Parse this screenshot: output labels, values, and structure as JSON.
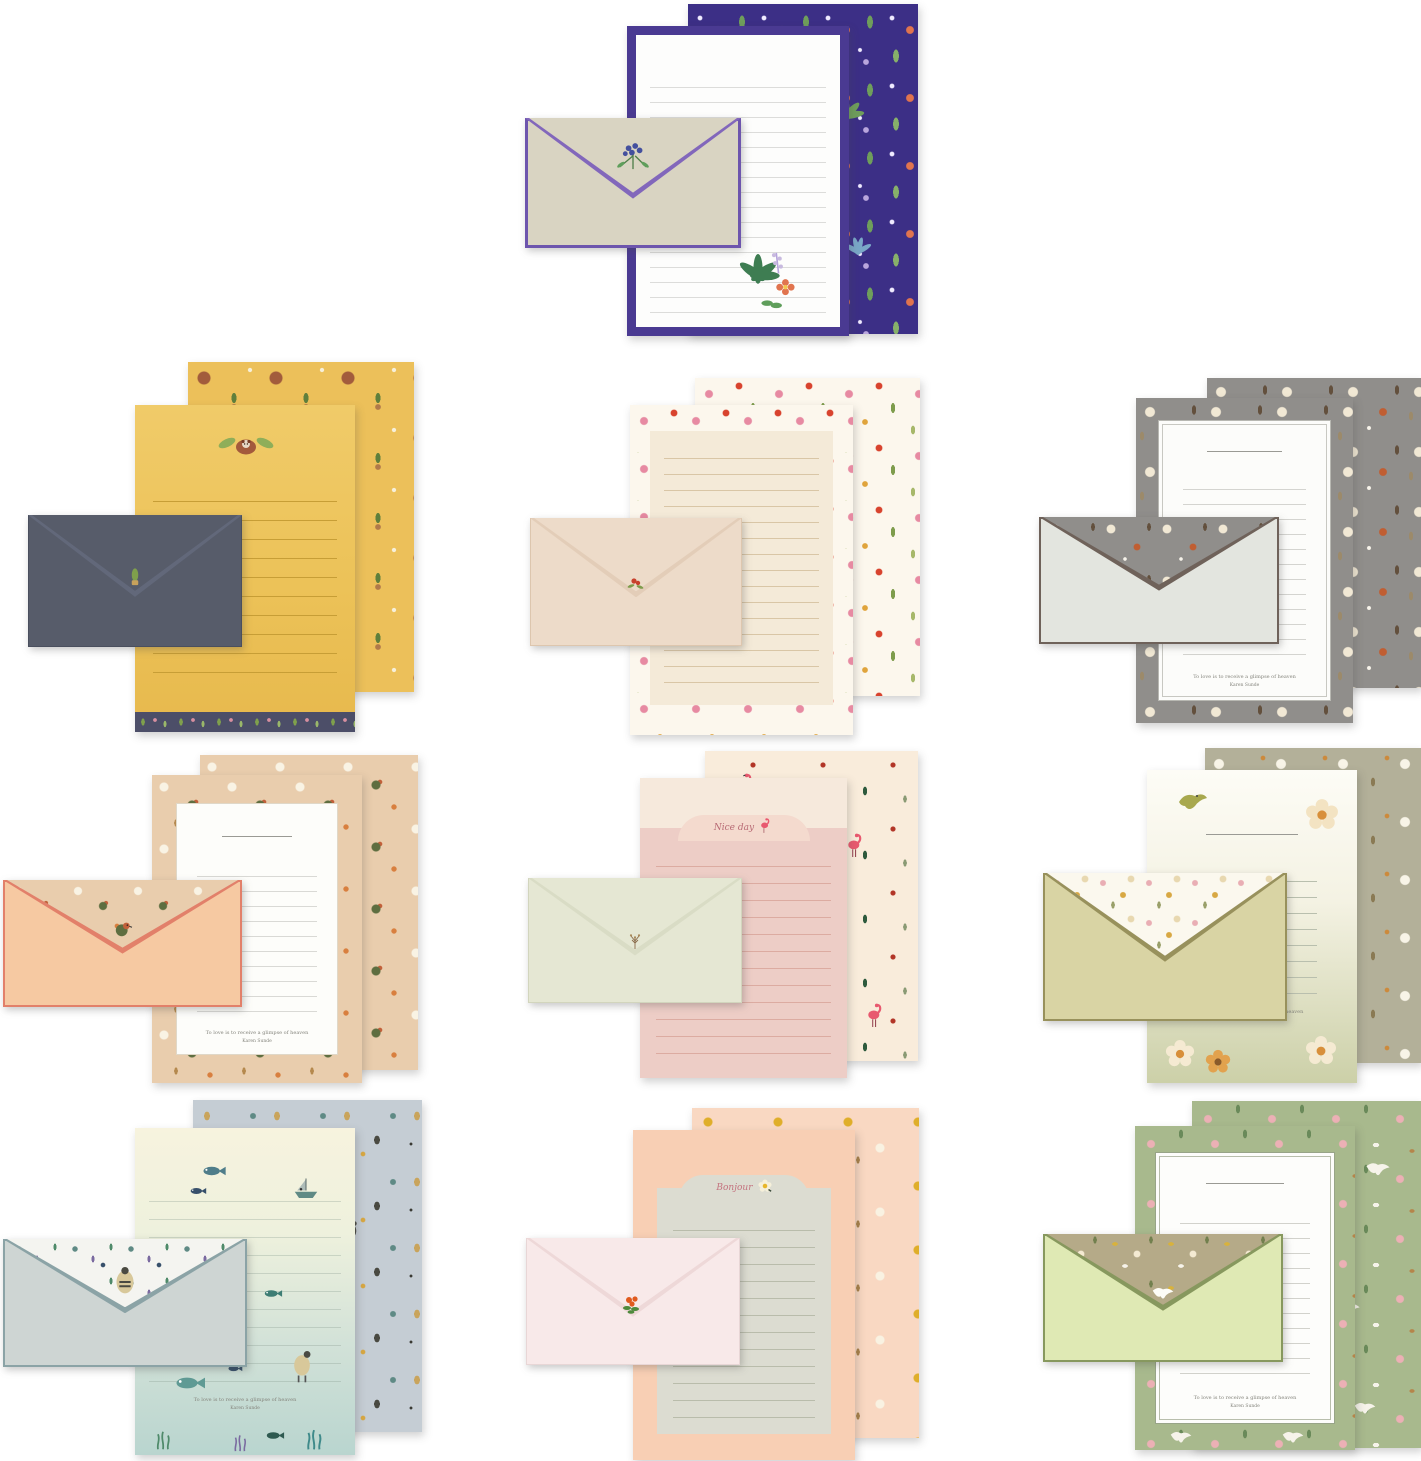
{
  "product": {
    "title": "Stationery letter writing paper and envelope sets, 10 designs",
    "quote": "To love is to receive a glimpse of heaven",
    "quote_author": "Karen Sunde",
    "sets": [
      {
        "id": 1,
        "name": "purple-botanical",
        "position": "top-center",
        "paper_color": "#3c2f86",
        "front_border": "#4a3a92",
        "envelope_body": "#d9d4c2",
        "envelope_trim": "#7c5fb5",
        "motifs": [
          "ferns",
          "palm-leaves",
          "stars",
          "orange-flowers",
          "lavender"
        ],
        "sticker": "blue-flower-bouquet"
      },
      {
        "id": 2,
        "name": "yellow-red-panda-cactus",
        "position": "row2-left",
        "paper_color": "#ecc05a",
        "strip_color": "#4c4e68",
        "envelope_body": "#575c6a",
        "motifs": [
          "red-panda",
          "cactus",
          "leaf-wings"
        ],
        "sticker": "cactus-pot"
      },
      {
        "id": 3,
        "name": "cream-wildflower-border",
        "position": "row2-center",
        "paper_color": "#f4ead8",
        "pattern_base": "#fcf7ed",
        "envelope_body": "#eddbc9",
        "motifs": [
          "pink-flowers",
          "red-poppies",
          "green-leaves"
        ],
        "sticker": "red-flower"
      },
      {
        "id": 4,
        "name": "gray-autumn-floral",
        "position": "row2-right",
        "paper_color": "#908e8b",
        "panel_color": "#fcfcfa",
        "envelope_body": "#e3e5df",
        "envelope_trim": "#6f625a",
        "motifs": [
          "cream-flowers",
          "rust-birds",
          "brown-leaves"
        ],
        "quote": "To love is to receive a glimpse of heaven",
        "quote_author": "Karen Sunde"
      },
      {
        "id": 5,
        "name": "peach-robins",
        "position": "row3-left",
        "paper_color": "#e9cdad",
        "panel_color": "#fdfdfa",
        "envelope_body": "#f6c9a2",
        "envelope_trim": "#e2806a",
        "motifs": [
          "daisies",
          "robins",
          "orange-berries"
        ],
        "quote": "To love is to receive a glimpse of heaven",
        "quote_author": "Karen Sunde"
      },
      {
        "id": 6,
        "name": "pink-flamingo",
        "position": "row3-center",
        "paper_color": "#edcdc6",
        "pattern_base": "#f9ecdb",
        "envelope_body": "#e5e7d3",
        "motifs": [
          "flamingos",
          "dark-leaves",
          "red-berries"
        ],
        "script": "Nice day",
        "sticker": "seed-sprig"
      },
      {
        "id": 7,
        "name": "sage-cream-blossom",
        "position": "row3-right",
        "paper_color": "#b3b099",
        "front_gradient": [
          "#fdfcf6",
          "#ccd0a8"
        ],
        "envelope_body": "#d9d4a4",
        "envelope_trim": "#98915c",
        "motifs": [
          "cream-flowers",
          "olive-bird",
          "butterflies"
        ],
        "quote": "To love is to receive a glimpse of heaven",
        "quote_author": "Karen Sunde"
      },
      {
        "id": 8,
        "name": "ocean-fish",
        "position": "row4-left",
        "paper_color": "#c5cdd4",
        "front_gradient": [
          "#f7f3de",
          "#b9d5cf"
        ],
        "envelope_body": "#ced5d3",
        "envelope_trim": "#8ba3a6",
        "motifs": [
          "fish",
          "sailboat",
          "seabirds",
          "seaweed",
          "waves"
        ],
        "quote": "To love is to receive a glimpse of heaven",
        "quote_author": "Karen Sunde"
      },
      {
        "id": 9,
        "name": "peach-bonjour",
        "position": "row4-center",
        "paper_color": "#f8cfb4",
        "panel_color": "#dcdcd1",
        "pattern_base": "#f9d8c2",
        "envelope_body": "#f8e9e9",
        "motifs": [
          "yellow-dots",
          "plumeria-flowers"
        ],
        "script": "Bonjour",
        "sticker": "red-flower-cluster"
      },
      {
        "id": 10,
        "name": "green-swallows",
        "position": "row4-right",
        "paper_color": "#a8b98d",
        "panel_color": "#fdfdfb",
        "envelope_body": "#dfe9b4",
        "envelope_trim": "#87985e",
        "flap_color": "#b5aa88",
        "motifs": [
          "white-swallows",
          "pink-flowers",
          "fawns",
          "gold-caterpillars"
        ],
        "quote": "To love is to receive a glimpse of heaven",
        "quote_author": "Karen Sunde"
      }
    ]
  }
}
